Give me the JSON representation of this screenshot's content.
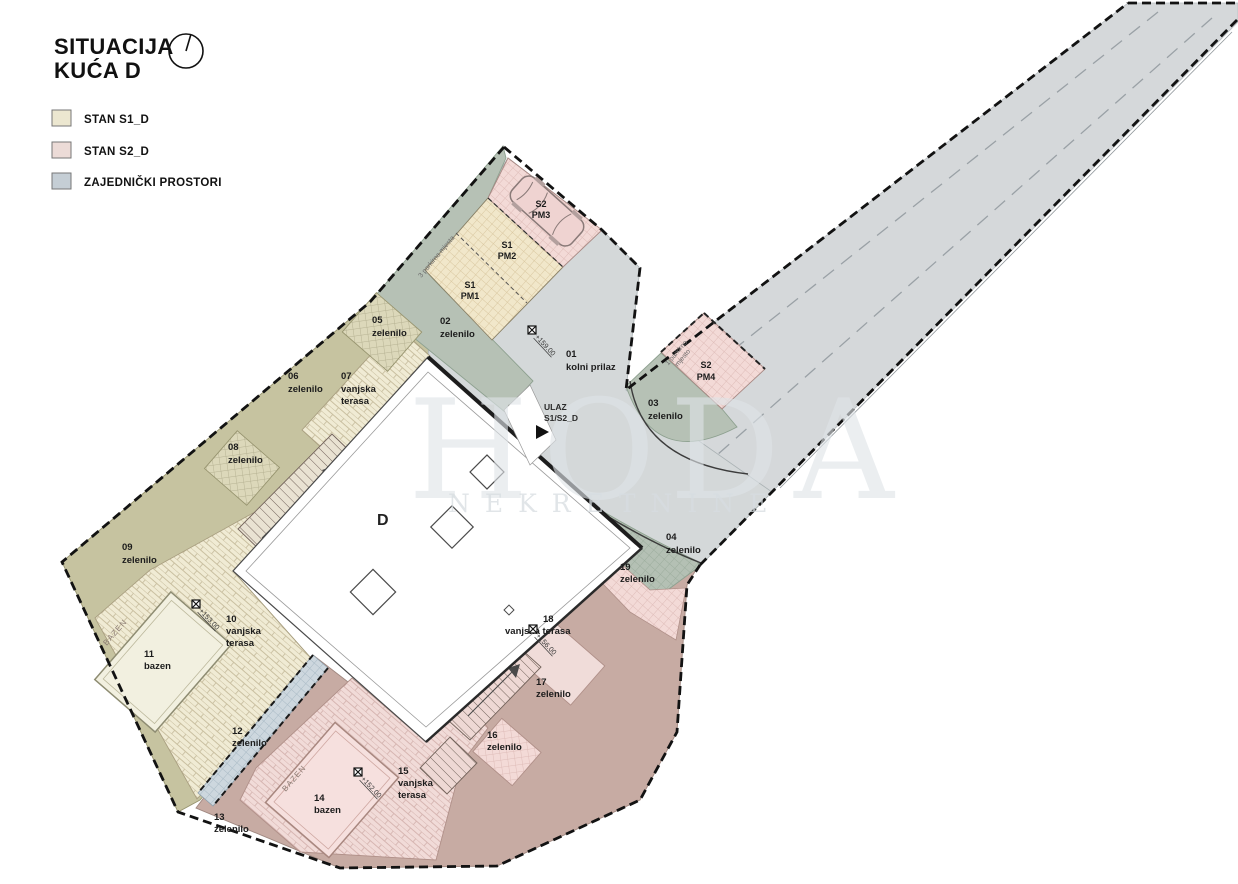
{
  "title": {
    "line1": "SITUACIJA",
    "line2": "KUĆA D"
  },
  "legend": {
    "items": [
      {
        "label": "STAN S1_D",
        "color": "#ece7d0"
      },
      {
        "label": "STAN S2_D",
        "color": "#ecdbd7"
      },
      {
        "label": "ZAJEDNIČKI PROSTORI",
        "color": "#c5ced5"
      }
    ]
  },
  "watermark": {
    "line1": "HODA",
    "line2": "NEKRETNINE"
  },
  "plan": {
    "building_label": "D",
    "entrance": {
      "line1": "ULAZ",
      "line2": "S1/S2_D"
    },
    "pool_text": "BAZEN",
    "zones": [
      {
        "num": "01",
        "name": "kolni prilaz"
      },
      {
        "num": "02",
        "name": "zelenilo"
      },
      {
        "num": "03",
        "name": "zelenilo"
      },
      {
        "num": "04",
        "name": "zelenilo"
      },
      {
        "num": "05",
        "name": "zelenilo"
      },
      {
        "num": "06",
        "name": "zelenilo"
      },
      {
        "num": "07",
        "name": "vanjska",
        "name2": "terasa"
      },
      {
        "num": "08",
        "name": "zelenilo"
      },
      {
        "num": "09",
        "name": "zelenilo"
      },
      {
        "num": "10",
        "name": "vanjska",
        "name2": "terasa"
      },
      {
        "num": "11",
        "name": "bazen"
      },
      {
        "num": "12",
        "name": "zelenilo"
      },
      {
        "num": "13",
        "name": "zelenilo"
      },
      {
        "num": "14",
        "name": "bazen"
      },
      {
        "num": "15",
        "name": "vanjska",
        "name2": "terasa"
      },
      {
        "num": "16",
        "name": "zelenilo"
      },
      {
        "num": "17",
        "name": "zelenilo"
      },
      {
        "num": "18",
        "name": "vanjska terasa"
      },
      {
        "num": "19",
        "name": "zelenilo"
      }
    ],
    "parking": [
      {
        "unit": "S1",
        "code": "PM1"
      },
      {
        "unit": "S1",
        "code": "PM2"
      },
      {
        "unit": "S2",
        "code": "PM3"
      },
      {
        "unit": "S2",
        "code": "PM4"
      }
    ],
    "notes": {
      "three": "3 parkirna mjesta",
      "one1": "1 parkirno",
      "one2": "mjesto"
    },
    "elevations": [
      "+159.00",
      "+153.00",
      "+156.00",
      "+152.00"
    ]
  }
}
